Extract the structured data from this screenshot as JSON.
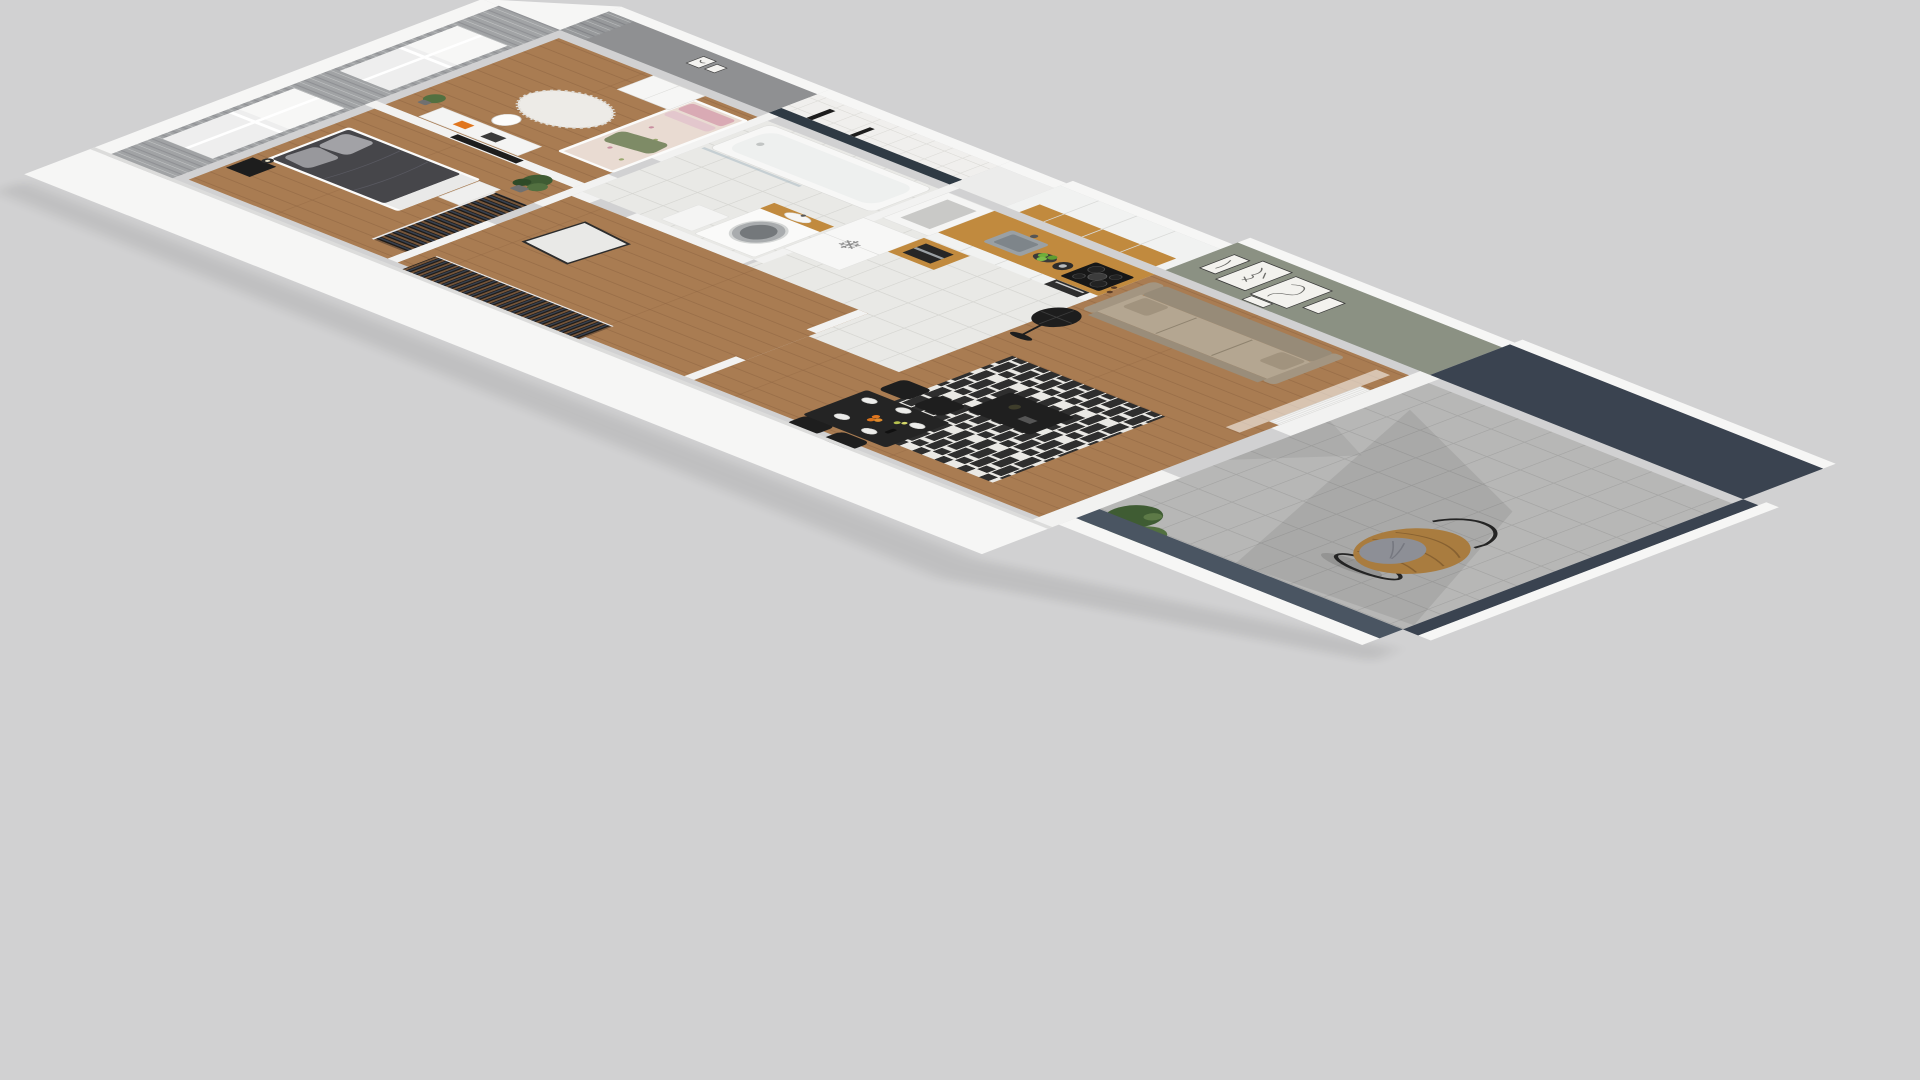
{
  "meta": {
    "description": "3D isometric dollhouse render of a one-bedroom-plus apartment floor plan on a plain gray backdrop",
    "view": "axonometric top-down rotated clockwise, balcony at lower right"
  },
  "icons": {
    "snowflake": "❄"
  },
  "colors": {
    "background": "#d1d1d2",
    "wall_white": "#f6f6f5",
    "wall_shade": "#ececeb",
    "wall_edge": "#dcdcdb",
    "wall_gray": "#8f9092",
    "curtain": "#97999b",
    "curtain_fold": "#7d7f82",
    "window": "#eceded",
    "wood": "#a97c52",
    "wood_line": "#8c6240",
    "tile": "#e9e9e6",
    "tile_line": "#d7d7d3",
    "bathtile": "#f0efed",
    "bath_navy": "#2f3a44",
    "sage": "#8b9183",
    "cabinet": "#f1f2f1",
    "counter_wood": "#c18a3e",
    "steel": "#9aa0a4",
    "dark": "#1d1d1d",
    "sofa_back": "#978b78",
    "sofa_seat": "#b4a691",
    "sofa_arm": "#a39581",
    "sofa_front": "#9a8d7a",
    "rug_dark": "#2e2e2e",
    "rug_light": "#eae9e5",
    "table_black": "#242424",
    "coffee_black": "#1f1f1f",
    "balcony_navy": "#3a4350",
    "parapet": "#4a5562",
    "concrete": "#b7b7b6",
    "concrete_line": "#a6a6a5",
    "rattan": "#a97c3f",
    "rattan_weave": "#7e5a2e",
    "cushion": "#8d8f96",
    "plant": "#3f5c33",
    "plant2": "#527040",
    "plant3": "#2f4a28",
    "clothes_bg": "#1e1b18",
    "clothes_a": "#75553a",
    "clothes_b": "#37404f",
    "orange": "#e0761f",
    "apple": "#6fae3a",
    "pink": "#d9aab4",
    "floral": "#e9dbd2",
    "pillow_green": "#7e8b66",
    "duvet_dark": "#46464a",
    "shag": "#edebe7"
  },
  "scene": {
    "rooms": [
      {
        "name": "master-bedroom",
        "items": [
          "double-bed-dark",
          "nightstand",
          "lamp",
          "wardrobe-rack",
          "plant",
          "curtained-window"
        ]
      },
      {
        "name": "second-bedroom",
        "items": [
          "single-bed-floral",
          "desk",
          "chair",
          "tv",
          "wardrobe",
          "shag-rug",
          "plant",
          "curtained-window"
        ]
      },
      {
        "name": "hallway",
        "items": [
          "open-clothes-rack",
          "leaning-mirror"
        ]
      },
      {
        "name": "bathroom",
        "items": [
          "bathtub",
          "shower-glass",
          "washing-machine",
          "sink-counter",
          "cabinet"
        ]
      },
      {
        "name": "kitchen",
        "items": [
          "fridge-snowflake",
          "coffee-machine",
          "sink",
          "kettle",
          "apples",
          "induction-hob",
          "oven",
          "upper-cabinets",
          "wood-backsplash"
        ]
      },
      {
        "name": "living-room",
        "items": [
          "sofa-beige",
          "gallery-wall-5-frames",
          "floor-lamp",
          "striped-rug",
          "coffee-table",
          "dining-table",
          "4-chairs",
          "radiator",
          "curtain"
        ]
      },
      {
        "name": "balcony",
        "items": [
          "hanging-egg-chair",
          "concrete-tile-floor",
          "plants",
          "navy-walls"
        ]
      }
    ]
  }
}
